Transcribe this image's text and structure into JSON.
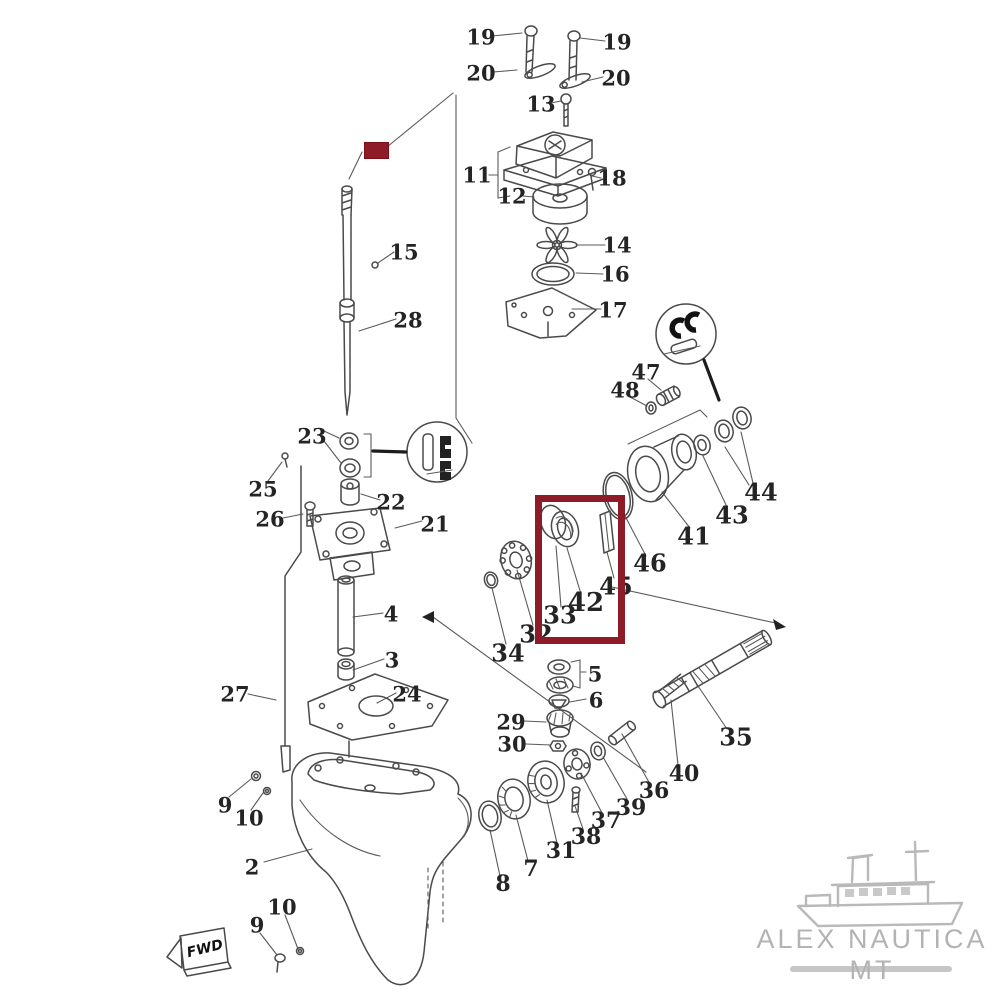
{
  "brand": {
    "name": "ALEX NAUTICA MT"
  },
  "fwd_badge": {
    "text": "FWD"
  },
  "highlights": {
    "color": "#8e1b28",
    "box": {
      "x": 535,
      "y": 495,
      "w": 76,
      "h": 135
    },
    "marker": {
      "x": 364,
      "y": 142,
      "w": 23,
      "h": 15
    }
  },
  "diagram": {
    "description": "Outboard motor lower unit exploded parts diagram",
    "labels": [
      {
        "id": "19-left",
        "text": "19",
        "x": 481,
        "y": 37
      },
      {
        "id": "19-right",
        "text": "19",
        "x": 617,
        "y": 42
      },
      {
        "id": "20-left",
        "text": "20",
        "x": 481,
        "y": 73
      },
      {
        "id": "20-right",
        "text": "20",
        "x": 616,
        "y": 78
      },
      {
        "id": "13",
        "text": "13",
        "x": 541,
        "y": 104
      },
      {
        "id": "11",
        "text": "11",
        "x": 477,
        "y": 175
      },
      {
        "id": "12",
        "text": "12",
        "x": 512,
        "y": 196
      },
      {
        "id": "18",
        "text": "18",
        "x": 612,
        "y": 178
      },
      {
        "id": "14",
        "text": "14",
        "x": 617,
        "y": 245
      },
      {
        "id": "16",
        "text": "16",
        "x": 615,
        "y": 274
      },
      {
        "id": "17",
        "text": "17",
        "x": 613,
        "y": 310
      },
      {
        "id": "15",
        "text": "15",
        "x": 404,
        "y": 252
      },
      {
        "id": "28",
        "text": "28",
        "x": 408,
        "y": 320
      },
      {
        "id": "23",
        "text": "23",
        "x": 312,
        "y": 436
      },
      {
        "id": "25",
        "text": "25",
        "x": 263,
        "y": 489
      },
      {
        "id": "26",
        "text": "26",
        "x": 270,
        "y": 519
      },
      {
        "id": "22",
        "text": "22",
        "x": 391,
        "y": 502
      },
      {
        "id": "21",
        "text": "21",
        "x": 435,
        "y": 524
      },
      {
        "id": "47",
        "text": "47",
        "x": 646,
        "y": 372
      },
      {
        "id": "48",
        "text": "48",
        "x": 625,
        "y": 390
      },
      {
        "id": "44",
        "text": "44",
        "x": 761,
        "y": 492,
        "size": 24
      },
      {
        "id": "43",
        "text": "43",
        "x": 732,
        "y": 515,
        "size": 24
      },
      {
        "id": "41",
        "text": "41",
        "x": 694,
        "y": 536,
        "size": 24
      },
      {
        "id": "46",
        "text": "46",
        "x": 650,
        "y": 563,
        "size": 24
      },
      {
        "id": "45",
        "text": "45",
        "x": 616,
        "y": 586,
        "size": 24
      },
      {
        "id": "42",
        "text": "42",
        "x": 586,
        "y": 603,
        "size": 26
      },
      {
        "id": "33",
        "text": "33",
        "x": 560,
        "y": 615,
        "size": 24
      },
      {
        "id": "32",
        "text": "32",
        "x": 536,
        "y": 634,
        "size": 24
      },
      {
        "id": "34",
        "text": "34",
        "x": 508,
        "y": 653,
        "size": 24
      },
      {
        "id": "4",
        "text": "4",
        "x": 391,
        "y": 614
      },
      {
        "id": "3",
        "text": "3",
        "x": 392,
        "y": 660
      },
      {
        "id": "27",
        "text": "27",
        "x": 235,
        "y": 694
      },
      {
        "id": "24",
        "text": "24",
        "x": 407,
        "y": 694
      },
      {
        "id": "5",
        "text": "5",
        "x": 595,
        "y": 674
      },
      {
        "id": "6",
        "text": "6",
        "x": 596,
        "y": 700
      },
      {
        "id": "29",
        "text": "29",
        "x": 511,
        "y": 722
      },
      {
        "id": "30",
        "text": "30",
        "x": 512,
        "y": 744
      },
      {
        "id": "35",
        "text": "35",
        "x": 736,
        "y": 737,
        "size": 24
      },
      {
        "id": "40",
        "text": "40",
        "x": 684,
        "y": 774,
        "size": 22
      },
      {
        "id": "36",
        "text": "36",
        "x": 654,
        "y": 791,
        "size": 22
      },
      {
        "id": "39",
        "text": "39",
        "x": 631,
        "y": 808,
        "size": 22
      },
      {
        "id": "37",
        "text": "37",
        "x": 606,
        "y": 821,
        "size": 22
      },
      {
        "id": "38",
        "text": "38",
        "x": 586,
        "y": 837,
        "size": 22
      },
      {
        "id": "31",
        "text": "31",
        "x": 561,
        "y": 851,
        "size": 22
      },
      {
        "id": "7",
        "text": "7",
        "x": 531,
        "y": 869,
        "size": 22
      },
      {
        "id": "8",
        "text": "8",
        "x": 503,
        "y": 884,
        "size": 22
      },
      {
        "id": "9-top",
        "text": "9",
        "x": 225,
        "y": 805
      },
      {
        "id": "10-top",
        "text": "10",
        "x": 249,
        "y": 818
      },
      {
        "id": "2",
        "text": "2",
        "x": 252,
        "y": 867
      },
      {
        "id": "10-bottom",
        "text": "10",
        "x": 282,
        "y": 907
      },
      {
        "id": "9-bottom",
        "text": "9",
        "x": 257,
        "y": 925
      }
    ]
  }
}
